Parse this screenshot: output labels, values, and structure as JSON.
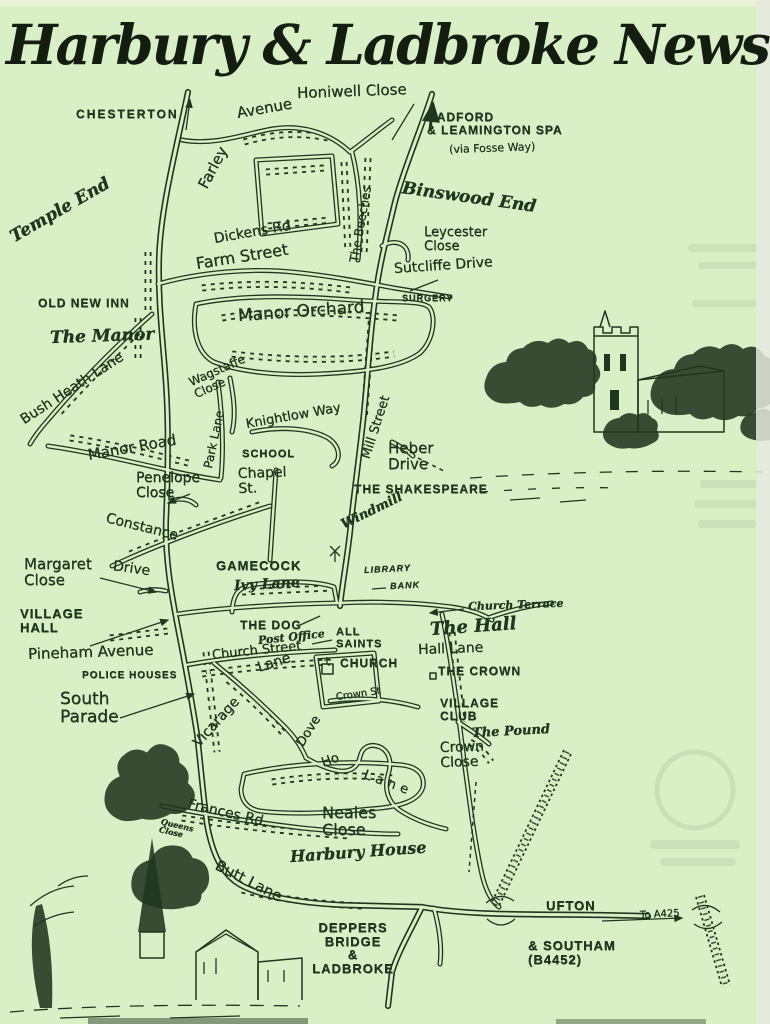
{
  "masthead": {
    "title": "Harbury & Ladbroke News"
  },
  "palette": {
    "paper": "#d9efc5",
    "ink": "#20361f",
    "scan_edge": "#e8e9df"
  },
  "map": {
    "labels": [
      {
        "name": "chesterton",
        "text": "CHESTERTON",
        "x": 76,
        "y": 108,
        "rot": 0,
        "style": "print",
        "size": 12,
        "spacing": 2
      },
      {
        "name": "honiwell-close",
        "text": "Honiwell Close",
        "x": 297,
        "y": 86,
        "rot": -2,
        "style": "hand",
        "size": 15
      },
      {
        "name": "farley",
        "text": "Farley",
        "x": 203,
        "y": 180,
        "rot": -62,
        "style": "hand",
        "size": 15
      },
      {
        "name": "avenue",
        "text": "Avenue",
        "x": 237,
        "y": 106,
        "rot": -10,
        "style": "hand",
        "size": 15
      },
      {
        "name": "radford-leamington",
        "text": "RADFORD\n& LEAMINGTON SPA",
        "x": 427,
        "y": 111,
        "rot": 0,
        "style": "print",
        "size": 12,
        "spacing": 1
      },
      {
        "name": "via-fosse-way",
        "text": "(via Fosse Way)",
        "x": 449,
        "y": 144,
        "rot": -2,
        "style": "hand",
        "size": 11
      },
      {
        "name": "temple-end",
        "text": "Temple End",
        "x": 12,
        "y": 230,
        "rot": -30,
        "style": "script",
        "size": 17
      },
      {
        "name": "the-beeches",
        "text": "The Beeches",
        "x": 354,
        "y": 256,
        "rot": -80,
        "style": "hand",
        "size": 12
      },
      {
        "name": "binswood-end",
        "text": "Binswood End",
        "x": 402,
        "y": 180,
        "rot": 8,
        "style": "script",
        "size": 17
      },
      {
        "name": "dickens-rd",
        "text": "Dickens Rd",
        "x": 214,
        "y": 232,
        "rot": -10,
        "style": "hand",
        "size": 14
      },
      {
        "name": "leycester-close",
        "text": "Leycester\n    Close",
        "x": 424,
        "y": 226,
        "rot": 0,
        "style": "hand",
        "size": 13
      },
      {
        "name": "farm-street",
        "text": "Farm Street",
        "x": 196,
        "y": 256,
        "rot": -9,
        "style": "hand",
        "size": 16
      },
      {
        "name": "sutcliffe-drive",
        "text": "Sutcliffe Drive",
        "x": 394,
        "y": 262,
        "rot": -4,
        "style": "hand",
        "size": 14
      },
      {
        "name": "surgery",
        "text": "SURGERY",
        "x": 402,
        "y": 294,
        "rot": 0,
        "style": "print",
        "size": 9,
        "spacing": 1
      },
      {
        "name": "old-new-inn",
        "text": "OLD NEW INN",
        "x": 38,
        "y": 297,
        "rot": 0,
        "style": "print",
        "size": 12,
        "spacing": 1
      },
      {
        "name": "manor-orchard",
        "text": "Manor Orchard",
        "x": 238,
        "y": 308,
        "rot": -4,
        "style": "hand",
        "size": 17
      },
      {
        "name": "the-manor",
        "text": "The Manor",
        "x": 50,
        "y": 330,
        "rot": -2,
        "style": "script",
        "size": 17
      },
      {
        "name": "bush-heath-lane",
        "text": "Bush Heath Lane",
        "x": 22,
        "y": 414,
        "rot": -33,
        "style": "hand",
        "size": 14
      },
      {
        "name": "wagstaffe-close",
        "text": "Wagstaffe\n  Close",
        "x": 192,
        "y": 376,
        "rot": -24,
        "style": "hand",
        "size": 12
      },
      {
        "name": "park-lane",
        "text": "Park Lane",
        "x": 208,
        "y": 462,
        "rot": -78,
        "style": "hand",
        "size": 12
      },
      {
        "name": "manor-road",
        "text": "Manor Road",
        "x": 88,
        "y": 448,
        "rot": -10,
        "style": "hand",
        "size": 15
      },
      {
        "name": "knightlow-way",
        "text": "Knightlow Way",
        "x": 246,
        "y": 418,
        "rot": -10,
        "style": "hand",
        "size": 13
      },
      {
        "name": "school",
        "text": "SCHOOL",
        "x": 242,
        "y": 449,
        "rot": 0,
        "style": "print",
        "size": 11,
        "spacing": 1
      },
      {
        "name": "mill-street",
        "text": "Mill Street",
        "x": 366,
        "y": 452,
        "rot": -72,
        "style": "hand",
        "size": 13
      },
      {
        "name": "heber-drive",
        "text": "Heber\nDrive",
        "x": 388,
        "y": 441,
        "rot": 0,
        "style": "hand",
        "size": 15
      },
      {
        "name": "chapel-st",
        "text": "Chapel\n   St.",
        "x": 238,
        "y": 467,
        "rot": -2,
        "style": "hand",
        "size": 14
      },
      {
        "name": "the-shakespeare",
        "text": "THE SHAKESPEARE",
        "x": 354,
        "y": 483,
        "rot": 0,
        "style": "print",
        "size": 12,
        "spacing": 1
      },
      {
        "name": "windmill",
        "text": "Windmill",
        "x": 342,
        "y": 519,
        "rot": -26,
        "style": "script",
        "size": 13
      },
      {
        "name": "penelope-close",
        "text": "Penelope\n   Close",
        "x": 136,
        "y": 471,
        "rot": 0,
        "style": "hand",
        "size": 14
      },
      {
        "name": "constance",
        "text": "Constance",
        "x": 106,
        "y": 511,
        "rot": 14,
        "style": "hand",
        "size": 14
      },
      {
        "name": "constance-drive",
        "text": "Drive",
        "x": 113,
        "y": 559,
        "rot": 8,
        "style": "hand",
        "size": 14
      },
      {
        "name": "margaret-close",
        "text": "Margaret\n  Close",
        "x": 24,
        "y": 557,
        "rot": 0,
        "style": "hand",
        "size": 15
      },
      {
        "name": "village-hall",
        "text": "VILLAGE\n  HALL",
        "x": 20,
        "y": 607,
        "rot": 0,
        "style": "print",
        "size": 13,
        "spacing": 1
      },
      {
        "name": "gamecock",
        "text": "GAMECOCK",
        "x": 216,
        "y": 559,
        "rot": 0,
        "style": "print",
        "size": 13,
        "spacing": 1
      },
      {
        "name": "ivy-lane",
        "text": "Ivy Lane",
        "x": 234,
        "y": 579,
        "rot": -3,
        "style": "script",
        "size": 14
      },
      {
        "name": "library",
        "text": "LIBRARY",
        "x": 364,
        "y": 566,
        "rot": -3,
        "style": "printi",
        "size": 9,
        "spacing": 1
      },
      {
        "name": "bank",
        "text": "BANK",
        "x": 390,
        "y": 582,
        "rot": -3,
        "style": "printi",
        "size": 9,
        "spacing": 1
      },
      {
        "name": "church-terrace",
        "text": "Church Terrace",
        "x": 468,
        "y": 601,
        "rot": -2,
        "style": "script",
        "size": 11
      },
      {
        "name": "the-dog",
        "text": "THE DOG",
        "x": 240,
        "y": 619,
        "rot": 0,
        "style": "print",
        "size": 12,
        "spacing": 1
      },
      {
        "name": "post-office",
        "text": "Post Office",
        "x": 258,
        "y": 635,
        "rot": -6,
        "style": "script",
        "size": 11
      },
      {
        "name": "all-saints",
        "text": "ALL\nSAINTS",
        "x": 336,
        "y": 627,
        "rot": 0,
        "style": "print",
        "size": 11,
        "spacing": 1
      },
      {
        "name": "the-hall",
        "text": "The Hall",
        "x": 430,
        "y": 621,
        "rot": -4,
        "style": "script",
        "size": 18
      },
      {
        "name": "hall-lane",
        "text": "Hall Lane",
        "x": 418,
        "y": 643,
        "rot": -2,
        "style": "hand",
        "size": 14
      },
      {
        "name": "the-crown",
        "text": "THE CROWN",
        "x": 438,
        "y": 665,
        "rot": 0,
        "style": "print",
        "size": 12,
        "spacing": 1
      },
      {
        "name": "church",
        "text": "CHURCH",
        "x": 340,
        "y": 657,
        "rot": 0,
        "style": "print",
        "size": 12,
        "spacing": 1
      },
      {
        "name": "pineham-avenue",
        "text": "Pineham Avenue",
        "x": 28,
        "y": 647,
        "rot": -2,
        "style": "hand",
        "size": 15
      },
      {
        "name": "police-houses",
        "text": "POLICE HOUSES",
        "x": 82,
        "y": 671,
        "rot": 0,
        "style": "print",
        "size": 10,
        "spacing": 1
      },
      {
        "name": "church-street",
        "text": "Church Street",
        "x": 212,
        "y": 649,
        "rot": -6,
        "style": "hand",
        "size": 13
      },
      {
        "name": "vicarage",
        "text": "Vicarage",
        "x": 196,
        "y": 738,
        "rot": -48,
        "style": "hand",
        "size": 14
      },
      {
        "name": "vicarage-lane",
        "text": "Lane",
        "x": 258,
        "y": 661,
        "rot": -18,
        "style": "hand",
        "size": 14
      },
      {
        "name": "south-parade",
        "text": "South\n   Parade",
        "x": 60,
        "y": 691,
        "rot": 0,
        "style": "hand",
        "size": 17
      },
      {
        "name": "crown-st",
        "text": "Crown St",
        "x": 336,
        "y": 693,
        "rot": -8,
        "style": "hand",
        "size": 10
      },
      {
        "name": "village-club",
        "text": "VILLAGE\n    CLUB",
        "x": 440,
        "y": 697,
        "rot": 0,
        "style": "print",
        "size": 12,
        "spacing": 1
      },
      {
        "name": "the-pound",
        "text": "The Pound",
        "x": 472,
        "y": 727,
        "rot": -3,
        "style": "script",
        "size": 13
      },
      {
        "name": "crown-close",
        "text": "Crown\n   Close",
        "x": 440,
        "y": 741,
        "rot": -2,
        "style": "hand",
        "size": 14
      },
      {
        "name": "dovehouse-dove",
        "text": "Dove",
        "x": 300,
        "y": 739,
        "rot": -58,
        "style": "hand",
        "size": 13
      },
      {
        "name": "dovehouse-ho",
        "text": "Ho",
        "x": 322,
        "y": 757,
        "rot": -20,
        "style": "hand",
        "size": 13
      },
      {
        "name": "dovehouse-lane",
        "text": "Lane",
        "x": 364,
        "y": 768,
        "rot": 20,
        "style": "hand",
        "size": 13,
        "spacing": 5
      },
      {
        "name": "neales-close",
        "text": "Neales\n Close",
        "x": 322,
        "y": 805,
        "rot": 0,
        "style": "hand",
        "size": 16
      },
      {
        "name": "frances-rd",
        "text": "Frances Rd.",
        "x": 188,
        "y": 797,
        "rot": 13,
        "style": "hand",
        "size": 14
      },
      {
        "name": "queens-close",
        "text": "Queens\nClose",
        "x": 160,
        "y": 817,
        "rot": 13,
        "style": "script",
        "size": 8
      },
      {
        "name": "harbury-house",
        "text": "Harbury House",
        "x": 290,
        "y": 849,
        "rot": -4,
        "style": "script",
        "size": 16
      },
      {
        "name": "butt-lane",
        "text": "Butt Lane",
        "x": 216,
        "y": 857,
        "rot": 27,
        "style": "hand",
        "size": 15
      },
      {
        "name": "ufton",
        "text": "UFTON",
        "x": 546,
        "y": 899,
        "rot": 0,
        "style": "print",
        "size": 13,
        "spacing": 1
      },
      {
        "name": "to-a425",
        "text": "To A425",
        "x": 640,
        "y": 911,
        "rot": -3,
        "style": "hand",
        "size": 10
      },
      {
        "name": "deppers-bridge-ladbroke",
        "text": "DEPPERS\nBRIDGE\n&\nLADBROKE",
        "x": 278,
        "y": 921,
        "rot": 0,
        "style": "print",
        "size": 13,
        "spacing": 1,
        "align": "center",
        "width": 150
      },
      {
        "name": "southam-b4452",
        "text": "& SOUTHAM\n    (B4452)",
        "x": 528,
        "y": 939,
        "rot": 0,
        "style": "print",
        "size": 13,
        "spacing": 1
      }
    ]
  }
}
